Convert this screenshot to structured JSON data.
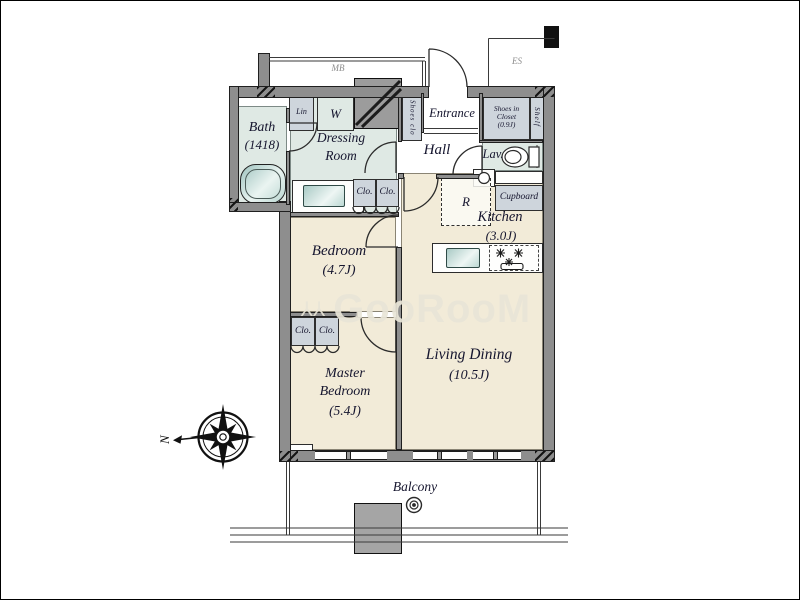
{
  "theme": {
    "wall": "#8e8e8e",
    "beige": "#f2ebd8",
    "green": "#dfe9e4",
    "box": "#ced5dc",
    "text": "#15152e",
    "watermark": "#e9e5d7"
  },
  "plan": {
    "watermark": {
      "icon": "⅄⅄",
      "text": "GooRooM"
    },
    "compass_n": "N",
    "corridor": {
      "mb": "MB",
      "es": "ES"
    },
    "rooms": {
      "bath": {
        "name": "Bath",
        "size": "(1418)"
      },
      "dressing": {
        "l1": "Dressing",
        "l2": "Room"
      },
      "entrance": "Entrance",
      "hall": "Hall",
      "lav": "Lav.",
      "kitchen": {
        "name": "Kitchen",
        "size": "(3.0J)"
      },
      "bedroom": {
        "name": "Bedroom",
        "size": "(4.7J)"
      },
      "living": {
        "name": "Living Dining",
        "size": "(10.5J)"
      },
      "master": {
        "l1": "Master",
        "l2": "Bedroom",
        "size": "(5.4J)"
      },
      "balcony": "Balcony"
    },
    "storage": {
      "lin": "Lin",
      "washer": "W",
      "shoes_clo": "Shoes clo",
      "shoes_in_closet": {
        "l1": "Shoes in",
        "l2": "Closet",
        "l3": "(0.9J)"
      },
      "shelf": "Shelf",
      "cupboard": "Cupboard",
      "fridge": "R",
      "closet": "Clo."
    }
  }
}
